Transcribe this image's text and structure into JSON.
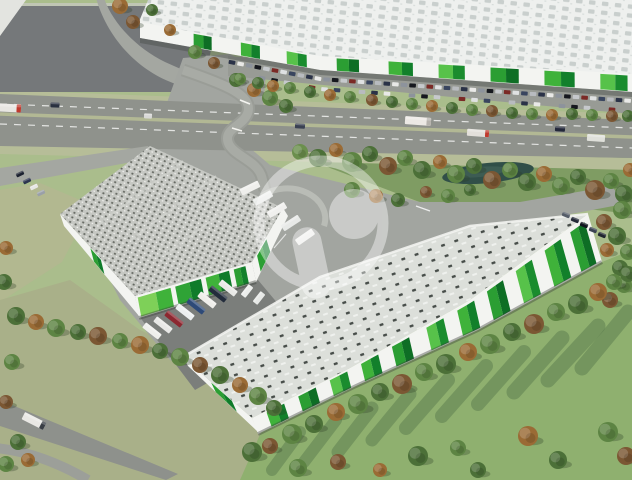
{
  "meta": {
    "description": "Aerial 3D architectural rendering of a logistics / industrial park: one large warehouse across the top behind a highway, two warehouses with green facade panels in the foreground, truck courts, parking, tree belts, meadows and a semi-transparent circular developer logo watermark in the center.",
    "image_type": "architectural-render",
    "contains_text": false
  },
  "palette": {
    "grass_base": "#aabd8c",
    "grass_dark": "#7f9c63",
    "meadow": "#8fb06f",
    "olive": "#a9b089",
    "olive2": "#b2b890",
    "lot_asphalt": "#75787a",
    "highway": "#8f928c",
    "road_light": "#a6a9a3",
    "plaza": "#a2a5a0",
    "yard_dark": "#7b7e7b",
    "verge": "#b6bd98",
    "roof_top_base": "#eef0ee",
    "roof_top_sky": "#c9cfcd",
    "roof_a_base": "#c6c8c3",
    "roof_b_base": "#dcdfda",
    "wall_white": "#f3f4f1",
    "green_bright": "#3fb23a",
    "green_mid": "#2b9e33",
    "green_dark": "#12802b",
    "green_lime": "#7ed058",
    "pond": "#314f48",
    "shadow_streak": "#55764a",
    "wedge": "#e3e4e0"
  },
  "watermark": {
    "name": "developer-logo-watermark",
    "glyph": "stylized-P-in-ring",
    "color": "#ffffff",
    "opacity": 0.42
  },
  "scene": {
    "tree_colors": [
      "#4c7038",
      "#5d8443",
      "#3a592d",
      "#9a6b35",
      "#7b5733",
      "#6b8f4d"
    ],
    "trees": [
      [
        120,
        6,
        8,
        3
      ],
      [
        133,
        22,
        7,
        4
      ],
      [
        152,
        10,
        6,
        0
      ],
      [
        170,
        30,
        6,
        3
      ],
      [
        195,
        52,
        7,
        1
      ],
      [
        214,
        63,
        6,
        4
      ],
      [
        236,
        80,
        7,
        0
      ],
      [
        254,
        90,
        7,
        3
      ],
      [
        270,
        98,
        8,
        1
      ],
      [
        286,
        106,
        7,
        0
      ],
      [
        240,
        79,
        6,
        1
      ],
      [
        258,
        83,
        6,
        0
      ],
      [
        273,
        86,
        6,
        3
      ],
      [
        290,
        88,
        6,
        1
      ],
      [
        310,
        92,
        6,
        0
      ],
      [
        330,
        95,
        6,
        3
      ],
      [
        350,
        97,
        6,
        1
      ],
      [
        372,
        100,
        6,
        4
      ],
      [
        392,
        102,
        6,
        0
      ],
      [
        412,
        104,
        6,
        1
      ],
      [
        432,
        106,
        6,
        3
      ],
      [
        452,
        108,
        6,
        0
      ],
      [
        472,
        110,
        6,
        1
      ],
      [
        492,
        111,
        6,
        4
      ],
      [
        512,
        113,
        6,
        0
      ],
      [
        532,
        114,
        6,
        1
      ],
      [
        552,
        115,
        6,
        3
      ],
      [
        572,
        114,
        6,
        0
      ],
      [
        592,
        115,
        6,
        1
      ],
      [
        612,
        116,
        6,
        4
      ],
      [
        628,
        116,
        6,
        0
      ],
      [
        300,
        152,
        8,
        5
      ],
      [
        318,
        158,
        9,
        0
      ],
      [
        336,
        150,
        7,
        3
      ],
      [
        352,
        162,
        10,
        1
      ],
      [
        370,
        154,
        8,
        0
      ],
      [
        388,
        166,
        9,
        4
      ],
      [
        405,
        158,
        8,
        1
      ],
      [
        422,
        170,
        9,
        0
      ],
      [
        440,
        162,
        7,
        3
      ],
      [
        456,
        174,
        9,
        1
      ],
      [
        474,
        166,
        8,
        0
      ],
      [
        492,
        180,
        9,
        4
      ],
      [
        510,
        170,
        8,
        1
      ],
      [
        527,
        182,
        9,
        0
      ],
      [
        544,
        174,
        8,
        3
      ],
      [
        561,
        186,
        9,
        1
      ],
      [
        578,
        177,
        8,
        0
      ],
      [
        595,
        190,
        10,
        4
      ],
      [
        611,
        181,
        8,
        1
      ],
      [
        624,
        194,
        9,
        0
      ],
      [
        630,
        170,
        7,
        3
      ],
      [
        622,
        210,
        9,
        1
      ],
      [
        604,
        222,
        8,
        4
      ],
      [
        617,
        236,
        9,
        0
      ],
      [
        628,
        252,
        8,
        1
      ],
      [
        607,
        250,
        7,
        3
      ],
      [
        620,
        268,
        8,
        0
      ],
      [
        624,
        285,
        8,
        1
      ],
      [
        610,
        300,
        8,
        4
      ],
      [
        352,
        190,
        8,
        1
      ],
      [
        376,
        196,
        7,
        3
      ],
      [
        398,
        200,
        7,
        0
      ],
      [
        426,
        192,
        6,
        4
      ],
      [
        448,
        196,
        7,
        1
      ],
      [
        470,
        190,
        6,
        0
      ],
      [
        252,
        452,
        10,
        0
      ],
      [
        270,
        446,
        8,
        4
      ],
      [
        292,
        434,
        10,
        1
      ],
      [
        314,
        424,
        9,
        0
      ],
      [
        336,
        412,
        9,
        3
      ],
      [
        358,
        404,
        10,
        1
      ],
      [
        380,
        392,
        9,
        0
      ],
      [
        402,
        384,
        10,
        4
      ],
      [
        424,
        372,
        9,
        1
      ],
      [
        446,
        364,
        10,
        0
      ],
      [
        468,
        352,
        9,
        3
      ],
      [
        490,
        344,
        10,
        1
      ],
      [
        512,
        332,
        9,
        0
      ],
      [
        534,
        324,
        10,
        4
      ],
      [
        556,
        312,
        9,
        1
      ],
      [
        578,
        304,
        10,
        0
      ],
      [
        598,
        292,
        9,
        3
      ],
      [
        614,
        282,
        8,
        1
      ],
      [
        628,
        274,
        8,
        0
      ],
      [
        298,
        468,
        9,
        1
      ],
      [
        338,
        462,
        8,
        4
      ],
      [
        418,
        456,
        10,
        0
      ],
      [
        458,
        448,
        8,
        1
      ],
      [
        528,
        436,
        10,
        3
      ],
      [
        558,
        460,
        9,
        0
      ],
      [
        608,
        432,
        10,
        1
      ],
      [
        626,
        456,
        9,
        4
      ],
      [
        478,
        470,
        8,
        0
      ],
      [
        380,
        470,
        7,
        3
      ],
      [
        16,
        316,
        9,
        0
      ],
      [
        36,
        322,
        8,
        3
      ],
      [
        56,
        328,
        9,
        1
      ],
      [
        78,
        332,
        8,
        0
      ],
      [
        98,
        336,
        9,
        4
      ],
      [
        120,
        341,
        8,
        1
      ],
      [
        140,
        345,
        9,
        3
      ],
      [
        160,
        351,
        8,
        0
      ],
      [
        180,
        357,
        9,
        1
      ],
      [
        200,
        365,
        8,
        4
      ],
      [
        220,
        375,
        9,
        0
      ],
      [
        240,
        385,
        8,
        3
      ],
      [
        258,
        396,
        9,
        1
      ],
      [
        274,
        408,
        8,
        0
      ],
      [
        6,
        248,
        7,
        3
      ],
      [
        4,
        282,
        8,
        0
      ],
      [
        12,
        362,
        8,
        1
      ],
      [
        6,
        402,
        7,
        4
      ],
      [
        18,
        442,
        8,
        0
      ],
      [
        6,
        464,
        8,
        1
      ],
      [
        28,
        460,
        7,
        3
      ]
    ],
    "pond": {
      "cx": 488,
      "cy": 173,
      "rx": 46,
      "ry": 10,
      "rot": -6,
      "color": "#314f48"
    },
    "shadow_streaks": [
      [
        300,
        432,
        272,
        470,
        12
      ],
      [
        336,
        420,
        304,
        462,
        12
      ],
      [
        372,
        408,
        338,
        452,
        13
      ],
      [
        410,
        394,
        372,
        440,
        13
      ],
      [
        448,
        380,
        406,
        428,
        14
      ],
      [
        486,
        366,
        442,
        416,
        14
      ],
      [
        524,
        352,
        478,
        404,
        14
      ],
      [
        562,
        338,
        514,
        392,
        15
      ],
      [
        598,
        326,
        548,
        380,
        15
      ],
      [
        628,
        312,
        582,
        368,
        15
      ]
    ],
    "top_building": {
      "label": "north-warehouse",
      "panels": [
        {
          "t": 0.11,
          "w": 0.037,
          "c1": "#2b9e33",
          "c2": "#0e6e25"
        },
        {
          "t": 0.207,
          "w": 0.039,
          "c1": "#3fb23a",
          "c2": "#12802b"
        },
        {
          "t": 0.301,
          "w": 0.041,
          "c1": "#57c24a",
          "c2": "#1a8c2e"
        },
        {
          "t": 0.403,
          "w": 0.045,
          "c1": "#2b9e33",
          "c2": "#0e6e25"
        },
        {
          "t": 0.508,
          "w": 0.049,
          "c1": "#3fb23a",
          "c2": "#12802b"
        },
        {
          "t": 0.609,
          "w": 0.053,
          "c1": "#57c24a",
          "c2": "#1a8c2e"
        },
        {
          "t": 0.714,
          "w": 0.057,
          "c1": "#2b9e33",
          "c2": "#0e6e25"
        },
        {
          "t": 0.823,
          "w": 0.061,
          "c1": "#3fb23a",
          "c2": "#12802b"
        },
        {
          "t": 0.936,
          "w": 0.055,
          "c1": "#57c24a",
          "c2": "#1a8c2e"
        }
      ]
    },
    "building_a": {
      "label": "west-warehouse",
      "panels": [
        {
          "t": 0.02,
          "w": 0.28,
          "c1": "#7ed058",
          "c2": "#3fb23a"
        },
        {
          "t": 0.34,
          "w": 0.22,
          "c1": "#2fa336",
          "c2": "#0f7c2a"
        },
        {
          "t": 0.6,
          "w": 0.2,
          "c1": "#3fb23a",
          "c2": "#0f7c2a"
        },
        {
          "t": 0.84,
          "w": 0.1,
          "c1": "#2b9e33",
          "c2": "#12802b"
        }
      ],
      "west_panels": [
        {
          "t": 0.4,
          "w": 0.14,
          "c1": "#2b9e33",
          "c2": "#0f7c2a"
        }
      ],
      "east_panels": [
        {
          "t": 0.15,
          "w": 0.3,
          "c1": "#2b9e33",
          "c2": "#0f7c2a"
        }
      ]
    },
    "building_b": {
      "label": "south-warehouse",
      "panels": [
        {
          "t": 0.04,
          "w": 0.05,
          "c1": "#3fb23a",
          "c2": "#12802b"
        },
        {
          "t": 0.13,
          "w": 0.05,
          "c1": "#2b9e33",
          "c2": "#0e6e25"
        },
        {
          "t": 0.22,
          "w": 0.05,
          "c1": "#57c24a",
          "c2": "#1a8c2e"
        },
        {
          "t": 0.31,
          "w": 0.05,
          "c1": "#3fb23a",
          "c2": "#12802b"
        },
        {
          "t": 0.4,
          "w": 0.05,
          "c1": "#2b9e33",
          "c2": "#0e6e25"
        },
        {
          "t": 0.5,
          "w": 0.05,
          "c1": "#57c24a",
          "c2": "#1a8c2e"
        },
        {
          "t": 0.59,
          "w": 0.05,
          "c1": "#3fb23a",
          "c2": "#12802b"
        },
        {
          "t": 0.68,
          "w": 0.05,
          "c1": "#2b9e33",
          "c2": "#0e6e25"
        },
        {
          "t": 0.77,
          "w": 0.05,
          "c1": "#57c24a",
          "c2": "#1a8c2e"
        },
        {
          "t": 0.86,
          "w": 0.05,
          "c1": "#3fb23a",
          "c2": "#12802b"
        },
        {
          "t": 0.94,
          "w": 0.045,
          "c1": "#2b9e33",
          "c2": "#0e6e25"
        }
      ],
      "west_panels": [
        {
          "t": 0.4,
          "w": 0.3,
          "c1": "#2b9e33",
          "c2": "#0f7c2a"
        }
      ]
    },
    "parking_north": {
      "row1": {
        "x0": 232,
        "x1": 628,
        "step": 8.6,
        "dy": 9
      },
      "row2": {
        "x0": 262,
        "x1": 618,
        "step": 12.5,
        "dy": 19
      },
      "colors": [
        "#2a3247",
        "#e9e9e7",
        "#8d939c",
        "#16181e",
        "#c6c9cc",
        "#7b2a26",
        "#dfe1e2",
        "#39455f",
        "#b8bbbf"
      ]
    },
    "vehicles": {
      "highway": [
        {
          "x": 10,
          "y": 108,
          "w": 22,
          "h": 8,
          "r": 3,
          "c": "#e8e6e2",
          "cab": "#c03a2e",
          "n": "truck"
        },
        {
          "x": 55,
          "y": 105,
          "w": 9,
          "h": 5,
          "r": 3,
          "c": "#2a3140",
          "n": "car"
        },
        {
          "x": 148,
          "y": 116,
          "w": 8,
          "h": 5,
          "r": 3,
          "c": "#d8d8d6",
          "n": "car"
        },
        {
          "x": 300,
          "y": 126,
          "w": 10,
          "h": 5,
          "r": 3,
          "c": "#3a4152",
          "n": "car"
        },
        {
          "x": 418,
          "y": 121,
          "w": 26,
          "h": 8,
          "r": 4,
          "c": "#ece9e4",
          "cab": "#b5b2ac",
          "n": "bus"
        },
        {
          "x": 478,
          "y": 133,
          "w": 22,
          "h": 7,
          "r": 4,
          "c": "#e2dfda",
          "cab": "#c03a2e",
          "n": "truck"
        },
        {
          "x": 560,
          "y": 129,
          "w": 10,
          "h": 5,
          "r": 4,
          "c": "#23283a",
          "n": "car"
        },
        {
          "x": 596,
          "y": 138,
          "w": 18,
          "h": 7,
          "r": 4,
          "c": "#dfe0da",
          "n": "truck"
        }
      ],
      "plaza_buses": [
        {
          "x": 250,
          "y": 188,
          "w": 20,
          "h": 7,
          "r": -26,
          "c": "#efefec",
          "n": "bus"
        },
        {
          "x": 263,
          "y": 198,
          "w": 20,
          "h": 7,
          "r": -29,
          "c": "#e9ebe9",
          "n": "bus"
        },
        {
          "x": 277,
          "y": 210,
          "w": 20,
          "h": 7,
          "r": -31,
          "c": "#f0f0ee",
          "n": "bus"
        },
        {
          "x": 291,
          "y": 223,
          "w": 20,
          "h": 7,
          "r": -33,
          "c": "#e7e9e7",
          "n": "bus"
        },
        {
          "x": 305,
          "y": 237,
          "w": 20,
          "h": 7,
          "r": -35,
          "c": "#eeeeec",
          "n": "bus"
        },
        {
          "x": 247,
          "y": 291,
          "w": 13,
          "h": 6,
          "r": -52,
          "c": "#eceeec",
          "n": "truck"
        },
        {
          "x": 259,
          "y": 298,
          "w": 13,
          "h": 6,
          "r": -52,
          "c": "#e6e8e6",
          "n": "truck"
        }
      ],
      "dock_trucks": [
        {
          "x": 152,
          "y": 331,
          "c": "#efefec"
        },
        {
          "x": 163,
          "y": 325,
          "c": "#e8e8e6"
        },
        {
          "x": 174,
          "y": 319,
          "c": "#8c2730"
        },
        {
          "x": 185,
          "y": 312,
          "c": "#eceff0"
        },
        {
          "x": 196,
          "y": 306,
          "c": "#2e4a78"
        },
        {
          "x": 207,
          "y": 300,
          "c": "#efeeea"
        },
        {
          "x": 218,
          "y": 294,
          "c": "#232c3c"
        },
        {
          "x": 228,
          "y": 288,
          "c": "#e9e9e7"
        }
      ],
      "west_cars": [
        {
          "x": 20,
          "y": 174,
          "c": "#1c2230"
        },
        {
          "x": 27,
          "y": 181,
          "c": "#2c3550"
        },
        {
          "x": 34,
          "y": 187,
          "c": "#e6e6e4"
        },
        {
          "x": 41,
          "y": 193,
          "c": "#9aa0a8"
        }
      ],
      "east_cars": [
        {
          "x": 566,
          "y": 215,
          "c": "#555d68"
        },
        {
          "x": 575,
          "y": 220,
          "c": "#242a38"
        },
        {
          "x": 584,
          "y": 225,
          "c": "#11151f"
        },
        {
          "x": 593,
          "y": 230,
          "c": "#3a4252"
        },
        {
          "x": 602,
          "y": 235,
          "c": "#20262f"
        }
      ],
      "sw_truck": {
        "x": 34,
        "y": 421,
        "w": 24,
        "h": 8,
        "r": 27,
        "c": "#e9e8e4",
        "cab": "#3a3f46",
        "n": "truck"
      }
    }
  }
}
